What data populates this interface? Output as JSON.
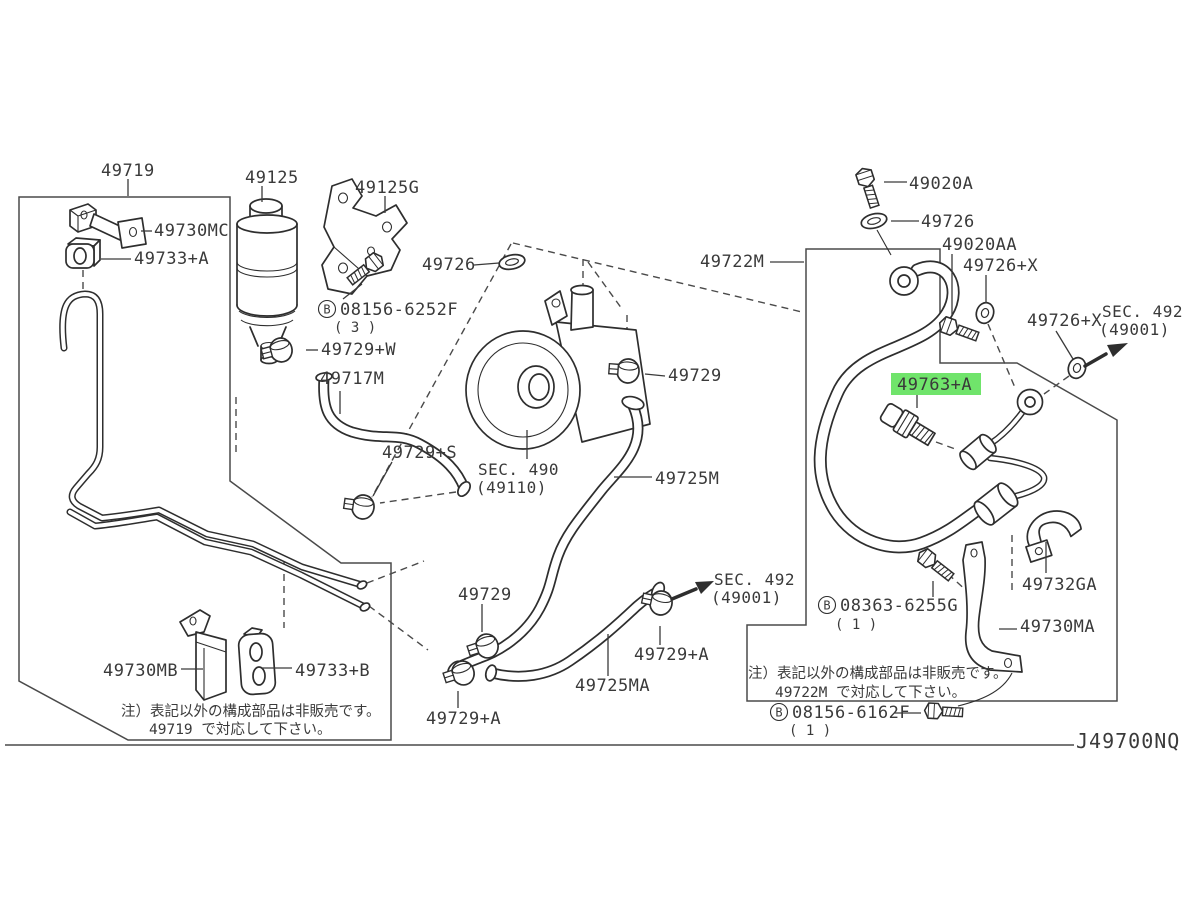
{
  "diagram": {
    "code": "J49700NQ",
    "kind": "power-steering-piping parts diagram"
  },
  "colors": {
    "line": "#2e2e2e",
    "label": "#3a3a3a",
    "highlight_bg": "#70e46b"
  },
  "parts": {
    "p49719": "49719",
    "p49730mc": "49730MC",
    "p49733a": "49733+A",
    "p49125": "49125",
    "p49125g": "49125G",
    "p49726_mid": "49726",
    "b6252f": {
      "prefix": "B",
      "num": "08156-6252F",
      "qty": "( 3 )"
    },
    "p49729w": "49729+W",
    "p49717m": "49717M",
    "p49729s": "49729+S",
    "sec490": {
      "line1": "SEC. 490",
      "line2": "(49110)"
    },
    "p49729_mid": "49729",
    "p49725m": "49725M",
    "p49729_bot": "49729",
    "sec492_bot": {
      "line1": "SEC. 492",
      "line2": "(49001)"
    },
    "p49729a_right": "49729+A",
    "p49725ma": "49725MA",
    "p49729a_left": "49729+A",
    "p49730mb": "49730MB",
    "p49733b": "49733+B",
    "note_left": {
      "line1": "注）表記以外の構成部品は非販売です。",
      "line2": "49719 で対応して下さい。"
    },
    "p49020a": "49020A",
    "p49726_r": "49726",
    "p49020aa": "49020AA",
    "p49726x_1": "49726+X",
    "p49722m": "49722M",
    "p49726x_2": "49726+X",
    "sec492_top": {
      "line1": "SEC. 492",
      "line2": "(49001)"
    },
    "p49763a": "49763+A",
    "p49732ga": "49732GA",
    "b6255g": {
      "prefix": "B",
      "num": "08363-6255G",
      "qty": "( 1 )"
    },
    "p49730ma": "49730MA",
    "note_right": {
      "line1": "注）表記以外の構成部品は非販売です。",
      "line2": "49722M で対応して下さい。"
    },
    "b6162f": {
      "prefix": "B",
      "num": "08156-6162F",
      "qty": "( 1 )"
    }
  }
}
